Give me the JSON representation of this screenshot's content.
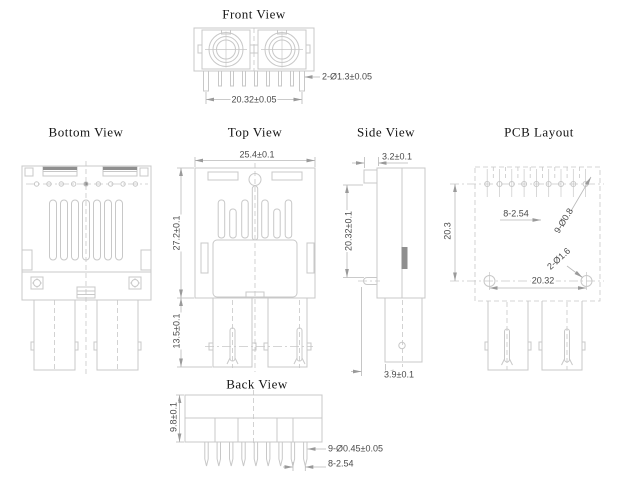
{
  "colors": {
    "line": "#c8c8c8",
    "dark_fill": "#8f8f8f",
    "dimension_text": "#4a4a4a",
    "title_text": "#141414",
    "background": "#ffffff"
  },
  "views": {
    "front": {
      "title": "Front View",
      "dims": {
        "pin_diameter": "2-Ø1.3±0.05",
        "pin_span": "20.32±0.05"
      }
    },
    "bottom": {
      "title": "Bottom View"
    },
    "top": {
      "title": "Top View",
      "dims": {
        "body_width": "25.4±0.1",
        "body_height": "27.2±0.1",
        "leg_height": "13.5±0.1"
      }
    },
    "side": {
      "title": "Side View",
      "dims": {
        "flange_thickness": "3.2±0.1",
        "body_height": "20.32±0.1",
        "leg_width": "3.9±0.1"
      }
    },
    "pcb": {
      "title": "PCB Layout",
      "dims": {
        "hole_pitch": "8-2.54",
        "pin_holes": "9-Ø0.8",
        "mount_holes": "2-Ø1.6",
        "hole_span_x": "20.32",
        "hole_span_y": "20.3"
      }
    },
    "back": {
      "title": "Back View",
      "dims": {
        "body_height": "9.8±0.1",
        "pin_diameter": "9-Ø0.45±0.05",
        "pin_pitch": "8-2.54"
      }
    }
  }
}
